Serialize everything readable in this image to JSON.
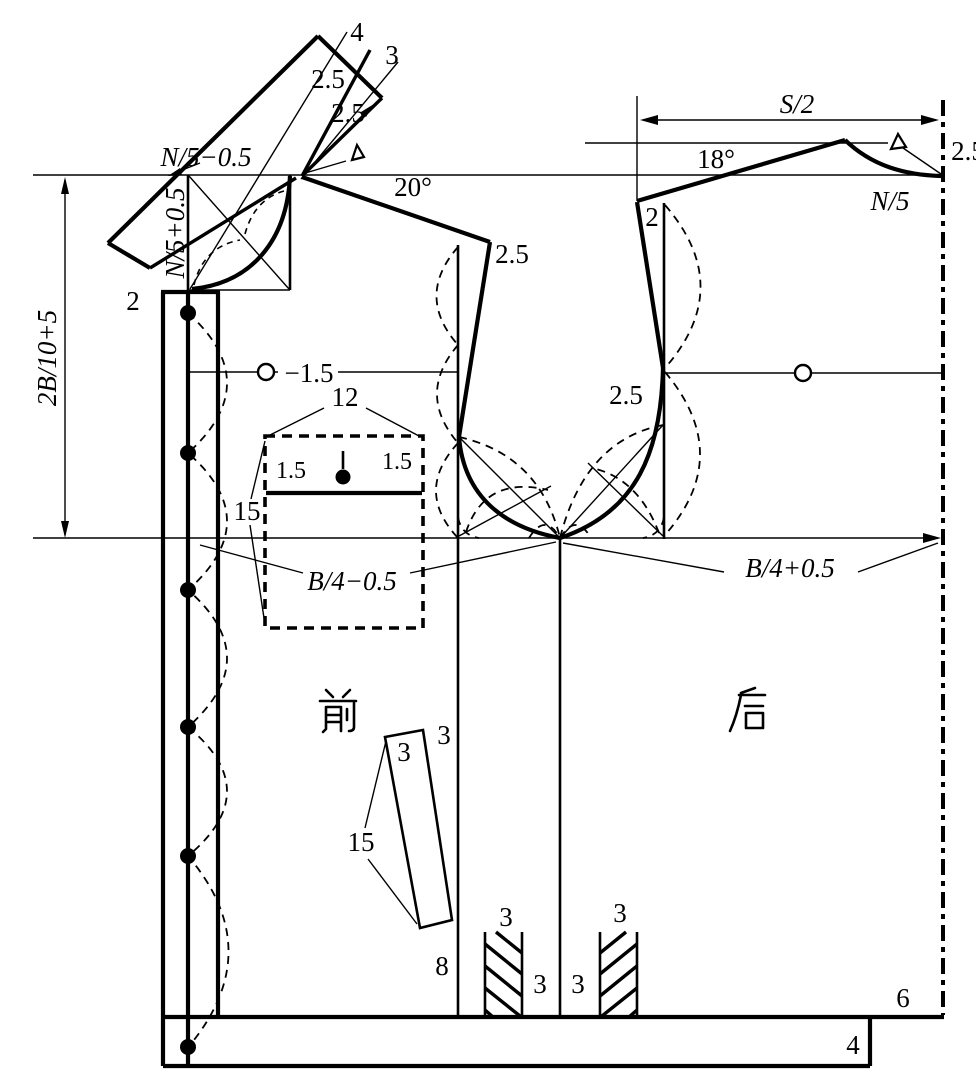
{
  "figure": {
    "kind": "garment-pattern-draft",
    "pieces": [
      "前",
      "后"
    ]
  },
  "labels": {
    "collar_tip": "4",
    "collar_band": "3",
    "collar_rise_upper": "2.5",
    "collar_rise_lower": "2.5",
    "neck_width_front": "N/5−0.5",
    "neck_depth_front": "N/5+0.5",
    "front_overlap": "2",
    "front_shoulder_angle": "20°",
    "armhole_depth": "2B/10+5",
    "front_shoulder_drop": "2.5",
    "chest_line_offset": "−1.5",
    "pocket_width": "12",
    "pocket_flap_left": "1.5",
    "pocket_flap_right": "1.5",
    "pocket_depth": "15",
    "front_chest": "B/4−0.5",
    "back_chest": "B/4+0.5",
    "front_name": "前",
    "back_name": "后",
    "strip_width_inner": "3",
    "strip_width_outer": "3",
    "strip_length": "15",
    "front_hem_panel": "8",
    "pleat_left_width": "3",
    "pleat_right_width": "3",
    "pleat_left_offset": "3",
    "pleat_right_offset": "3",
    "back_shoulder_angle": "18°",
    "back_width": "S/2",
    "back_neck": "N/5",
    "back_neck_rise": "2.5",
    "back_dart": "2",
    "back_armhole_in": "2.5",
    "back_vent": "6",
    "hem_band": "4"
  }
}
